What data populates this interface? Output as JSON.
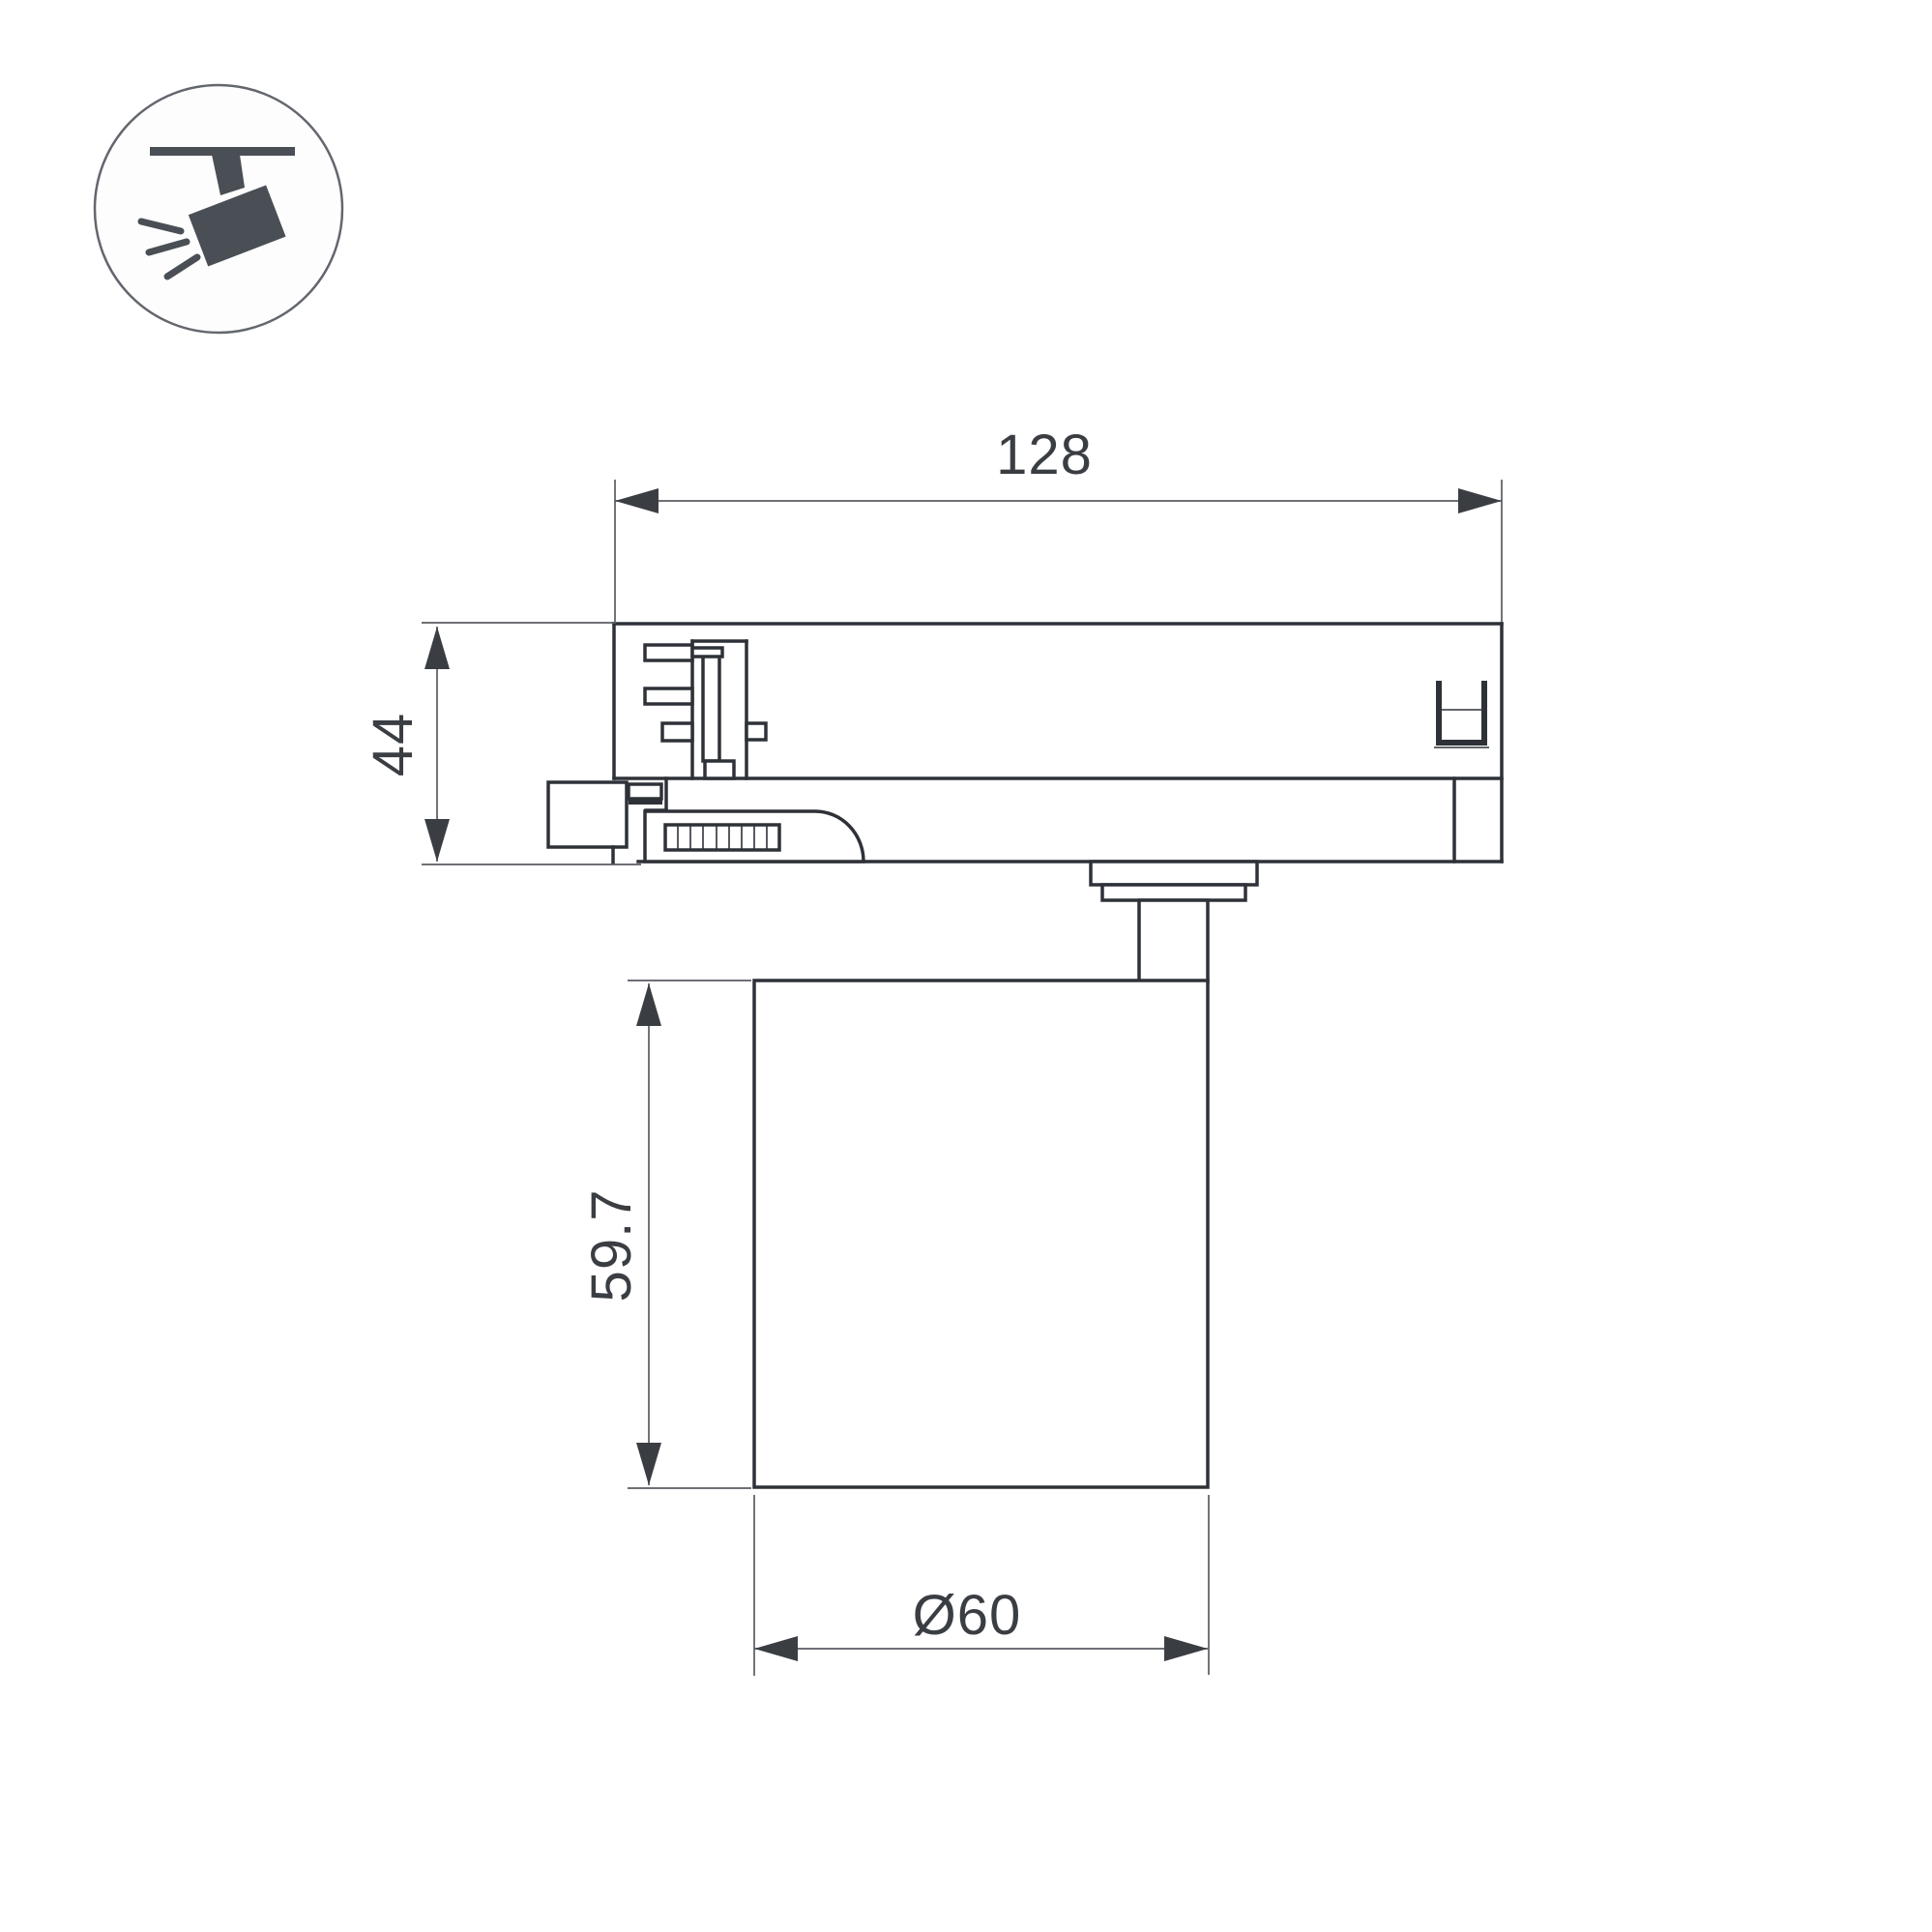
{
  "drawing": {
    "type": "technical-dimension-drawing",
    "subject": "track-mounted-spotlight-side-view",
    "dimensions": {
      "track_adapter_width": "128",
      "track_adapter_height": "44",
      "lamp_body_height": "59.7",
      "lamp_body_diameter": "Ø60"
    },
    "icon": {
      "name": "ceiling-track-spotlight",
      "description": "spotlight hanging from track emitting light rays"
    },
    "colors": {
      "background": "#ffffff",
      "outline_thick": "#2e3238",
      "outline_thin": "#595c62",
      "dimension_text": "#3a3e43",
      "icon_fill": "#4a4f55",
      "icon_circle_stroke": "#63676d"
    }
  }
}
